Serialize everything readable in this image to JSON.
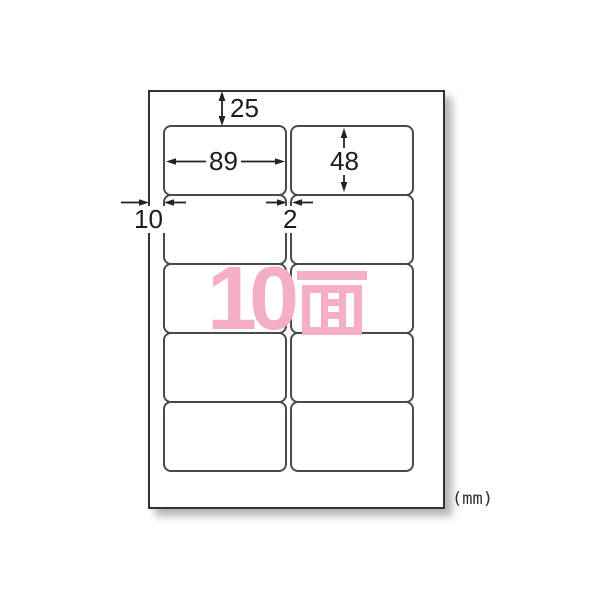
{
  "page": {
    "background_color": "#ffffff",
    "unit_label": "(mm)"
  },
  "sheet": {
    "rows": 5,
    "columns": 2,
    "label_shape": "rounded-rect",
    "face_count_text": "10面",
    "face_count_number": "10",
    "face_count_kanji": "面",
    "accent_color": "#f4aec8",
    "border_color": "#4a4a4a"
  },
  "dimensions_mm": {
    "top_margin": {
      "label": "25"
    },
    "label_width": {
      "label": "89"
    },
    "label_height": {
      "label": "48"
    },
    "left_margin": {
      "label": "10"
    },
    "column_gap": {
      "label": "2"
    }
  }
}
